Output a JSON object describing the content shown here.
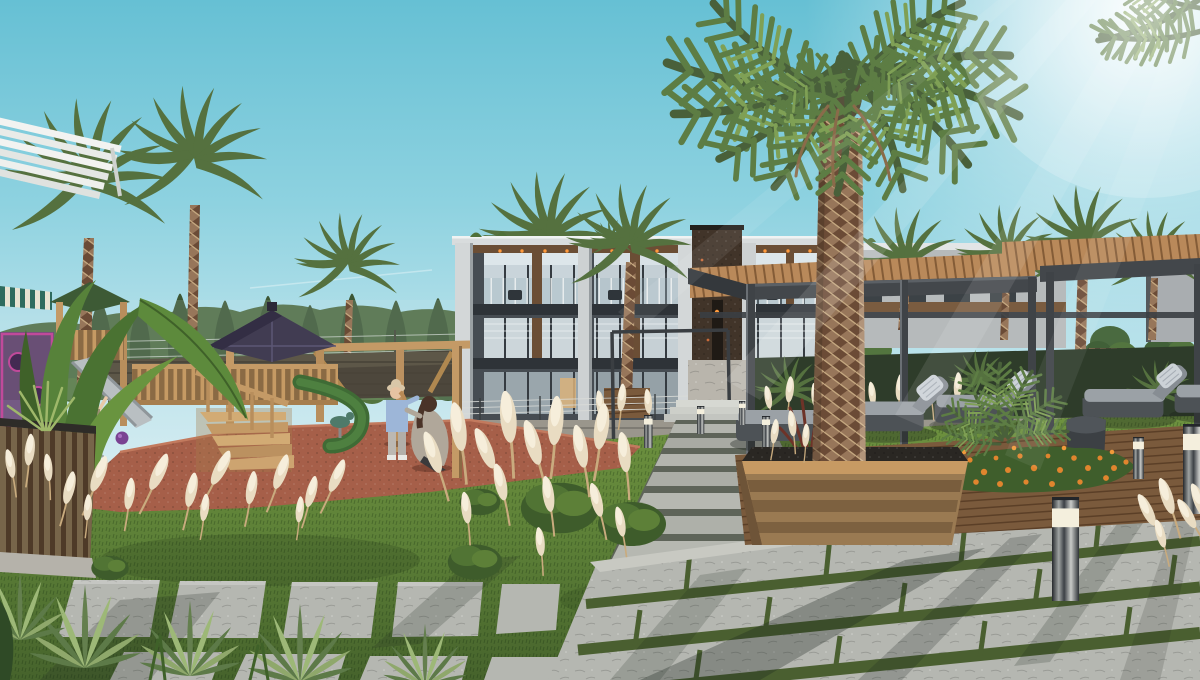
{
  "scene": {
    "type": "architectural-exterior-render",
    "description": "Sunlit courtyard of a modern low-rise residential complex: wooden children's playground with purple-roof gazebo on terracotta safety surface, tall palm trees, a large central palm in a wooden planter, pergola lounge deck with grey daybeds, orange flower bed, pampas grass, agaves and stone-paver lawn walkways with bollard lights. A toddler plays on the left; a standing child and a crouching adult are near the playground post.",
    "time_of_day": "day",
    "weather": "clear, bright sun from upper right"
  },
  "people": [
    "toddler-arms-raised",
    "child-standing-blue-top",
    "adult-crouching-beige-coat"
  ],
  "palette": {
    "sky_top": "#66c0d4",
    "sky_horizon": "#eef5f6",
    "sun_glow": "#ffffff",
    "building_dark": "#464c52",
    "building_light": "#b6babb",
    "roof_fascia": "#d8dcdd",
    "stone_tower": "#413429",
    "wood_accent": "#6b4e35",
    "window_glass": "#c9d4da",
    "pergola_steel": "#3f4347",
    "pergola_wood": "#b9895a",
    "palm_frond": "#5d7a44",
    "palm_trunk": "#8d6a4e",
    "tree_green": "#4d6b42",
    "lawn": "#5c7f37",
    "pampas": "#e9dcc2",
    "paver": "#b5b7b1",
    "paver_joint": "#4a5f30",
    "playground_surface": "#a65f49",
    "play_wood": "#c49a66",
    "gazebo_roof": "#413c52",
    "cushion_grey": "#9ba1a6",
    "daybed_base": "#4d5256",
    "flower_orange": "#e0852e",
    "warm_light": "#ff9a3d",
    "bollard_lamp": "#f4efdd"
  }
}
